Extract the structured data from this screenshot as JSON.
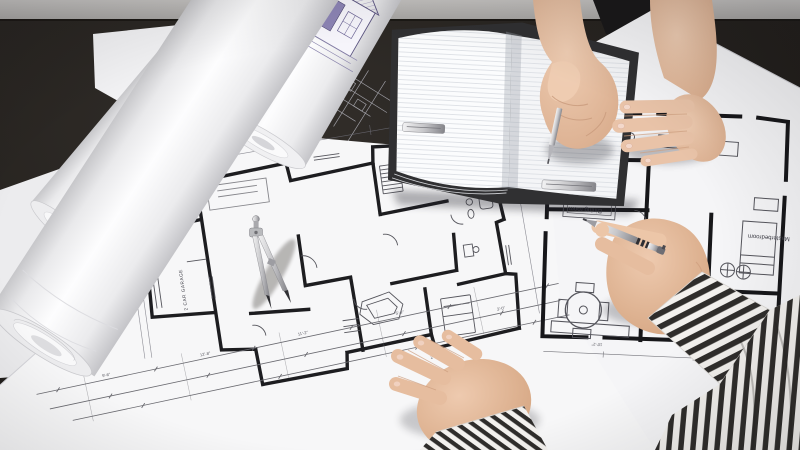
{
  "scene": {
    "type": "photograph",
    "description": "Two people at a dark table reviewing architectural floor plans; one writes in an open notebook, the other points at an upside-down floor plan with a silver pen; rolled-up elevation drawings lie at the top left and a drafting compass rests on the large center plan.",
    "labels": {
      "elevation": "ELEVATION",
      "dining_room": "Dining room",
      "kitchen": "kitchen",
      "master_bedroom": "Masterbedroom",
      "garage": "2 CAR GARAGE"
    },
    "dimension_marks": [
      "10'-2\"",
      "9'-6\"",
      "12'-8\"",
      "11'-2\"",
      "5'-4\"",
      "3'-0\"",
      "8'-6\"",
      "2'-8\""
    ],
    "palette": {
      "wall_gray": "#b5b3b1",
      "table_dark": "#24211e",
      "paper_white": "#f7f7f8",
      "paper_shadow": "#dddee2",
      "plan_ink": "#1d1d20",
      "thin_ink": "#55555c",
      "blueprint_accent_purple": "#8d84b5",
      "skin": "#e7c2a8",
      "skin_shadow": "#c79b7e",
      "pen_silver": "#c9c9cb",
      "sleeve_stripe_dark": "#2f2d2b",
      "sleeve_stripe_light": "#f3f1ee",
      "notebook_cover": "#303032",
      "notebook_clasp_silver": "#b9babc"
    }
  }
}
